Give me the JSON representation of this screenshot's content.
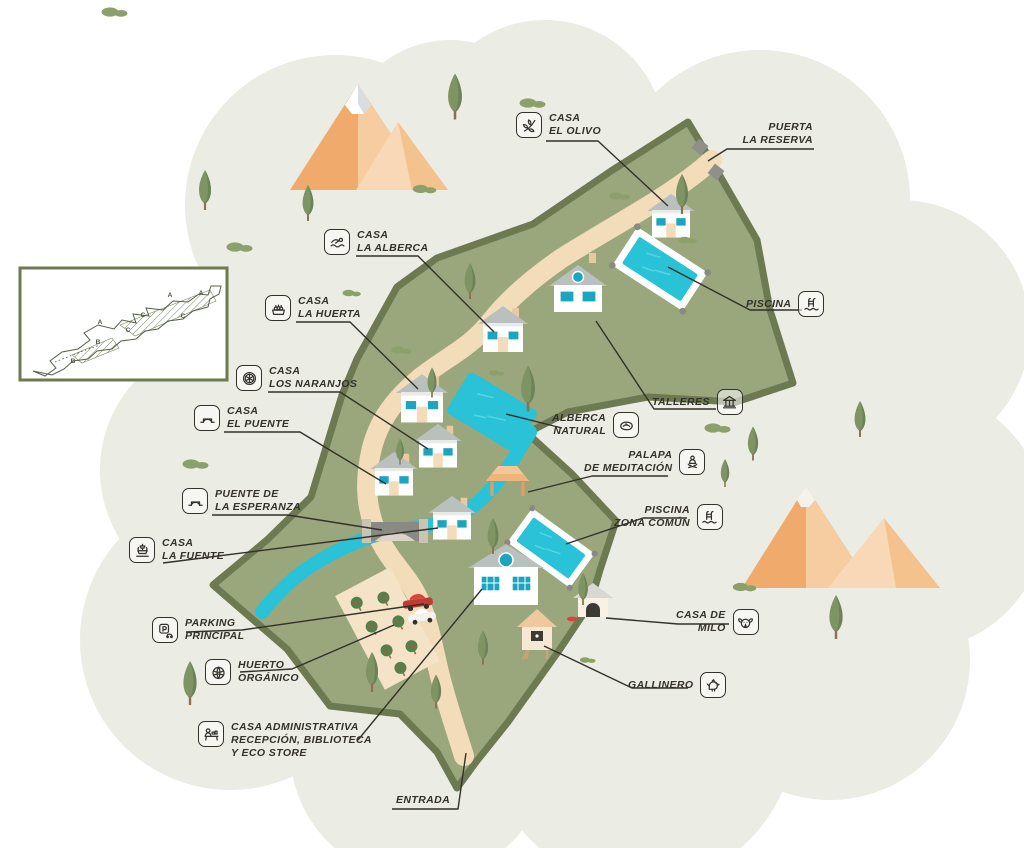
{
  "labels": [
    {
      "id": "casa-el-olivo",
      "icon": "olive-branch-icon",
      "lines": [
        "CASA",
        "EL OLIVO"
      ]
    },
    {
      "id": "puerta-la-reserva",
      "icon": null,
      "lines": [
        "PUERTA",
        "LA RESERVA"
      ]
    },
    {
      "id": "casa-la-alberca",
      "icon": "swimmer-icon",
      "lines": [
        "CASA",
        "LA ALBERCA"
      ]
    },
    {
      "id": "casa-la-huerta",
      "icon": "vegetable-crate-icon",
      "lines": [
        "CASA",
        "LA HUERTA"
      ]
    },
    {
      "id": "casa-los-naranjos",
      "icon": "orange-slice-icon",
      "lines": [
        "CASA",
        "LOS NARANJOS"
      ]
    },
    {
      "id": "casa-el-puente",
      "icon": "bridge-icon",
      "lines": [
        "CASA",
        "EL PUENTE"
      ]
    },
    {
      "id": "puente-de-la-esperanza",
      "icon": "bridge-icon",
      "lines": [
        "PUENTE DE",
        "LA ESPERANZA"
      ]
    },
    {
      "id": "casa-la-fuente",
      "icon": "fountain-icon",
      "lines": [
        "CASA",
        "LA FUENTE"
      ]
    },
    {
      "id": "parking-principal",
      "icon": "parking-icon",
      "lines": [
        "PARKING",
        "PRINCIPAL"
      ]
    },
    {
      "id": "huerto-organico",
      "icon": "lettuce-icon",
      "lines": [
        "HUERTO",
        "ORGÁNICO"
      ]
    },
    {
      "id": "casa-administrativa",
      "icon": "reception-icon",
      "lines": [
        "CASA ADMINISTRATIVA",
        "RECEPCIÓN, BIBLIOTECA",
        "Y ECO STORE"
      ]
    },
    {
      "id": "entrada",
      "icon": null,
      "lines": [
        "ENTRADA"
      ]
    },
    {
      "id": "piscina",
      "icon": "pool-ladder-icon",
      "lines": [
        "PISCINA"
      ]
    },
    {
      "id": "talleres",
      "icon": "workshop-icon",
      "lines": [
        "TALLERES"
      ]
    },
    {
      "id": "alberca-natural",
      "icon": "natural-pool-icon",
      "lines": [
        "ALBERCA",
        "NATURAL"
      ]
    },
    {
      "id": "palapa-de-meditacion",
      "icon": "meditation-icon",
      "lines": [
        "PALAPA",
        "DE MEDITACIÓN"
      ]
    },
    {
      "id": "piscina-zona-comun",
      "icon": "pool-ladder-icon",
      "lines": [
        "PISCINA",
        "ZONA COMÚN"
      ]
    },
    {
      "id": "casa-de-milo",
      "icon": "dog-icon",
      "lines": [
        "CASA DE",
        "MILO"
      ]
    },
    {
      "id": "gallinero",
      "icon": "chicken-icon",
      "lines": [
        "GALLINERO"
      ]
    }
  ],
  "inset": {
    "letters": [
      "A",
      "A",
      "A",
      "C",
      "C",
      "C",
      "B",
      "B"
    ]
  },
  "colors": {
    "terrain": "#9aa77c",
    "terrain_border": "#6d7950",
    "road": "#f3dcba",
    "water": "#29c2d6",
    "pool_border": "#ffffff",
    "background_blob": "#ebece4",
    "ink": "#33312a",
    "house_wall": "#ffffff",
    "house_roof": "#b9c0bd",
    "window": "#1ca5bf",
    "door": "#f3dcba",
    "mountain_main": "#f0a968",
    "mountain_light": "#f9d9b5",
    "tree_green": "#7e9463",
    "bush_green": "#8ba06b",
    "accent_red": "#d64541"
  }
}
